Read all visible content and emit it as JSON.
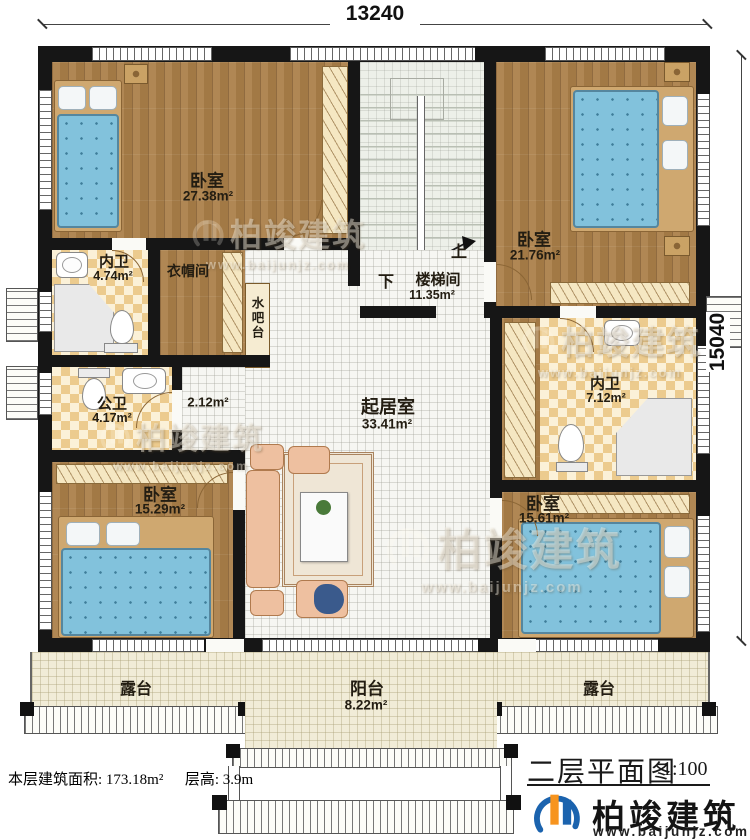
{
  "dimensions": {
    "top": "13240",
    "right": "15040"
  },
  "rooms": {
    "bedroom_tl": {
      "name": "卧室",
      "area": "27.38m²"
    },
    "bath_tl": {
      "name": "内卫",
      "area": "4.74m²"
    },
    "cloakroom": {
      "name": "衣帽间"
    },
    "water_bar": {
      "name": "水吧台"
    },
    "stairwell": {
      "name": "楼梯间",
      "area": "11.35m²",
      "up_label": "上",
      "down_label": "下"
    },
    "bedroom_tr": {
      "name": "卧室",
      "area": "21.76m²"
    },
    "bath_right": {
      "name": "内卫",
      "area": "7.12m²"
    },
    "bath_public": {
      "name": "公卫",
      "area": "4.17m²"
    },
    "hallway": {
      "area": "2.12m²"
    },
    "living_room": {
      "name": "起居室",
      "area": "33.41m²"
    },
    "bedroom_bl": {
      "name": "卧室",
      "area": "15.29m²"
    },
    "bedroom_br": {
      "name": "卧室",
      "area": "15.61m²"
    },
    "terrace_left": {
      "name": "露台"
    },
    "terrace_right": {
      "name": "露台"
    },
    "balcony": {
      "name": "阳台",
      "area": "8.22m²"
    }
  },
  "footer": {
    "floor_area": "本层建筑面积: 173.18m²",
    "floor_height": "层高: 3.9m"
  },
  "title_block": {
    "title": "二层平面图",
    "scale": "1:100",
    "brand": "柏竣建筑",
    "website": "www.baijunjz.com"
  },
  "watermark": {
    "brand": "柏竣建筑",
    "website": "www.baijunjz.com"
  },
  "colors": {
    "wall": "#161616",
    "wood_floor": "#ab8049",
    "tile_accent": "#eccb8e",
    "bed_blue": "#82c2dc",
    "sofa_peach": "#eec0a0",
    "brand_blue": "#1b63ae",
    "brand_orange": "#f7941e"
  }
}
